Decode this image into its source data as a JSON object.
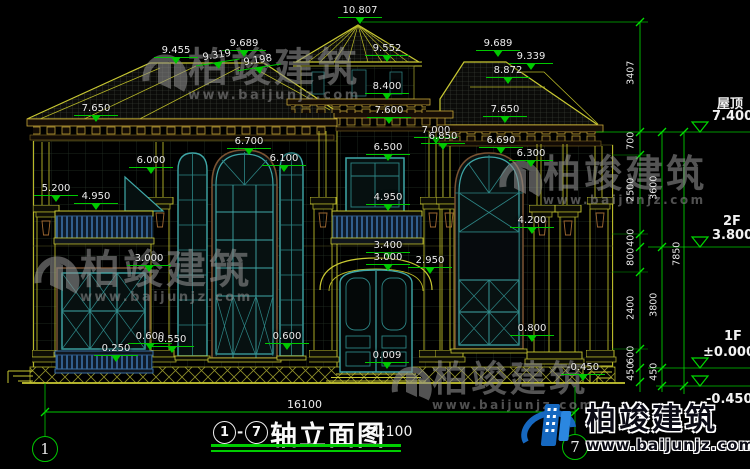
{
  "brand": {
    "name": "柏竣建筑",
    "url": "www.baijunjz.com"
  },
  "title_block": {
    "axis_from": "1",
    "axis_to": "7",
    "separator": "-",
    "drawing_name": "轴立面图",
    "scale": "1:100"
  },
  "axis_bubbles": {
    "left": "1",
    "right": "7"
  },
  "overall_dim": "16100",
  "levels": {
    "roof_label": "屋顶",
    "roof_value": "7.400",
    "f2_label": "2F",
    "f2_value": "3.800",
    "f1_label": "1F",
    "f1_value": "±0.000",
    "ground_value": "-0.450"
  },
  "dims": [
    "10.807",
    "9.455",
    "9.689",
    "9.319",
    "9.198",
    "9.552",
    "9.689",
    "9.339",
    "8.872",
    "8.400",
    "7.650",
    "7.600",
    "7.650",
    "7.000",
    "6.850",
    "6.700",
    "6.690",
    "6.500",
    "6.300",
    "6.100",
    "6.000",
    "5.200",
    "4.950",
    "4.950",
    "4.200",
    "3.400",
    "3.000",
    "2.950",
    "3.000",
    "0.800",
    "0.600",
    "0.550",
    "0.600",
    "0.250",
    "0.009",
    "-0.450"
  ],
  "chains": {
    "a": [
      "3407",
      "700",
      "2500",
      "400",
      "800",
      "2400",
      "600",
      "450"
    ],
    "b": [
      "3600",
      "3800",
      "450"
    ],
    "c": [
      "7850"
    ]
  }
}
